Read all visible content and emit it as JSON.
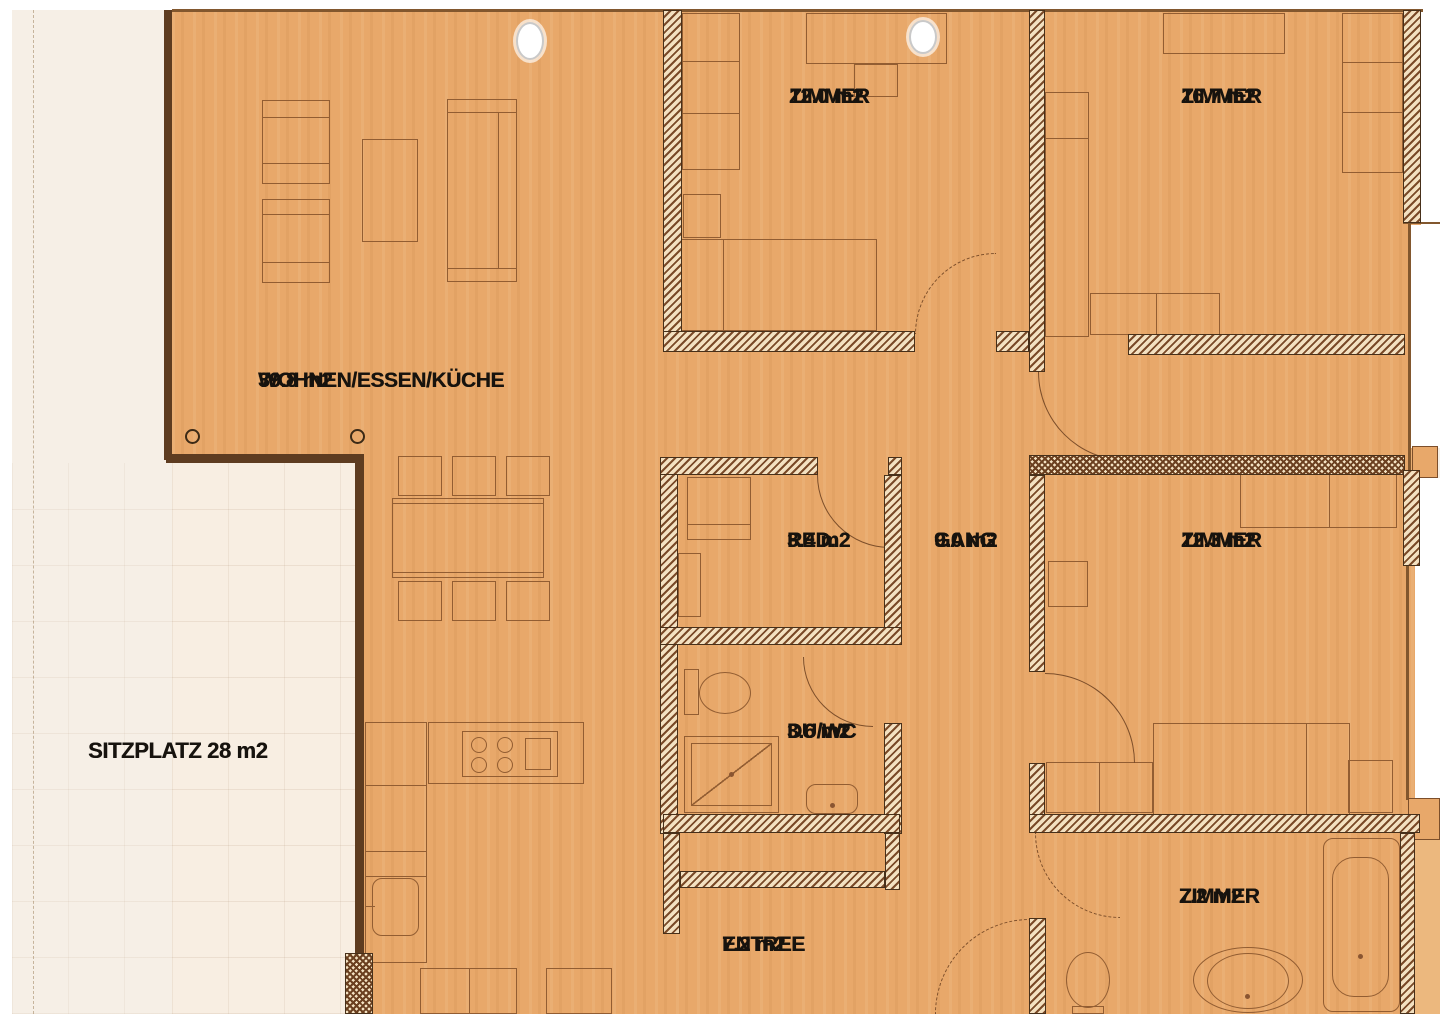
{
  "document": {
    "kind": "apartment floor plan (scanned)",
    "language": "German",
    "total_room_labels": 10
  },
  "rooms": [
    {
      "id": "wohnen-essen-kueche",
      "name": "WOHNEN/ESSEN/KÜCHE",
      "area": "39.8 m2",
      "x": 258,
      "y": 366
    },
    {
      "id": "zimmer-12-0",
      "name": "ZIMMER",
      "area": "12.0 m2",
      "x": 789,
      "y": 82
    },
    {
      "id": "zimmer-16-7",
      "name": "ZIMMER",
      "area": "16.7 m2",
      "x": 1181,
      "y": 82
    },
    {
      "id": "reduit",
      "name": "RED.",
      "area": "3.4 m2",
      "x": 787,
      "y": 526
    },
    {
      "id": "gang",
      "name": "GANG",
      "area": "9.0 m2",
      "x": 934,
      "y": 526
    },
    {
      "id": "zimmer-12-3",
      "name": "ZIMMER",
      "area": "12.3 m2",
      "x": 1181,
      "y": 526
    },
    {
      "id": "du-wc",
      "name": "DU/WC",
      "area": "3.6 m2",
      "x": 787,
      "y": 717
    },
    {
      "id": "entree",
      "name": "ENTREE",
      "area": "7.2 m2",
      "x": 722,
      "y": 930
    },
    {
      "id": "zimmer-7-2",
      "name": "ZIMMER",
      "area": "7.2 m2",
      "x": 1179,
      "y": 882
    },
    {
      "id": "sitzplatz",
      "name": "SITZPLATZ 28 m2",
      "area": "",
      "x": 88,
      "y": 736,
      "single": true
    }
  ],
  "colors": {
    "floor": "#e8a86a",
    "page": "#f6efe6",
    "sitzplatz": "#f8eee2",
    "wall_fill": "#f3e1c1",
    "wall_hatch": "#7a4a28",
    "wall_outline": "#47301a",
    "boundary": "#5e3c20",
    "furniture_line": "#925d32",
    "label_text": "#17130e"
  },
  "markers": {
    "punch_holes": 2,
    "column_dots": 2
  }
}
